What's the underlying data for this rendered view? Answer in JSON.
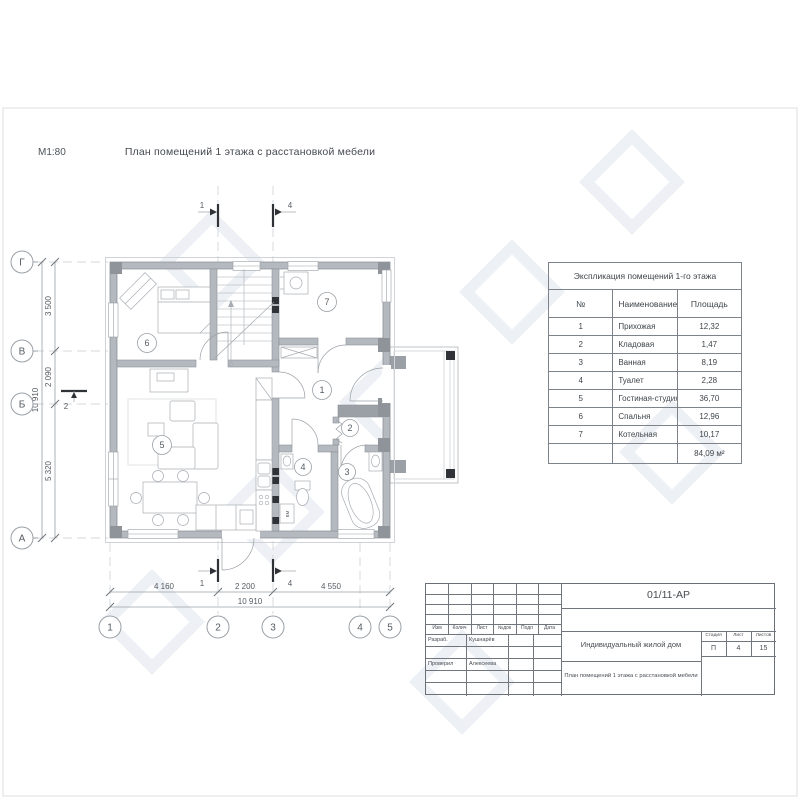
{
  "sheet": {
    "scale_label": "М1:80",
    "title": "План помещений 1 этажа с расстановкой мебели"
  },
  "plan": {
    "axes_left": [
      "Г",
      "В",
      "Б",
      "А"
    ],
    "axes_bottom": [
      "1",
      "2",
      "3",
      "4",
      "5"
    ],
    "dims_left": [
      "3 500",
      "2 090",
      "5 320"
    ],
    "dims_left_total": "10 910",
    "dims_bottom": [
      "4 160",
      "2 200",
      "4 550"
    ],
    "dims_bottom_total": "10 910",
    "rooms": [
      "1",
      "2",
      "3",
      "4",
      "5",
      "6",
      "7"
    ],
    "sections": {
      "s1": "1",
      "s4": "4",
      "s2": "2"
    },
    "washer_label": "ВМ"
  },
  "explication": {
    "title": "Экспликация помещений 1-го этажа",
    "col_num": "№",
    "col_name": "Наименование",
    "col_area": "Площадь",
    "rows": [
      {
        "num": "1",
        "name": "Прихожая",
        "area": "12,32"
      },
      {
        "num": "2",
        "name": "Кладовая",
        "area": "1,47"
      },
      {
        "num": "3",
        "name": "Ванная",
        "area": "8,19"
      },
      {
        "num": "4",
        "name": "Туалет",
        "area": "2,28"
      },
      {
        "num": "5",
        "name": "Гостиная-студия",
        "area": "36,70"
      },
      {
        "num": "6",
        "name": "Спальня",
        "area": "12,96"
      },
      {
        "num": "7",
        "name": "Котельная",
        "area": "10,17"
      }
    ],
    "total": "84,09 м²"
  },
  "stamp": {
    "code": "01/11-АР",
    "head_cols": [
      "Изм",
      "Колич",
      "Лист",
      "№док",
      "Подп",
      "Дата"
    ],
    "row1_role": "Разраб.",
    "row1_name": "Кушнарёв",
    "row2_role": "Проверил",
    "row2_name": "Алексеева",
    "object": "Индивидуальный жилой дом",
    "drawing": "План помещений 1 этажа с расстановкой мебели",
    "stage_label": "Стадия",
    "sheet_label": "Лист",
    "sheets_label": "Листов",
    "stage": "П",
    "sheet": "4",
    "sheets": "15"
  },
  "colors": {
    "wall": "#b4b9bf",
    "pier_dark": "#8f949a",
    "black_detail": "#2f3337",
    "line": "#9aa0a6",
    "watermark": "#edf1f5"
  }
}
